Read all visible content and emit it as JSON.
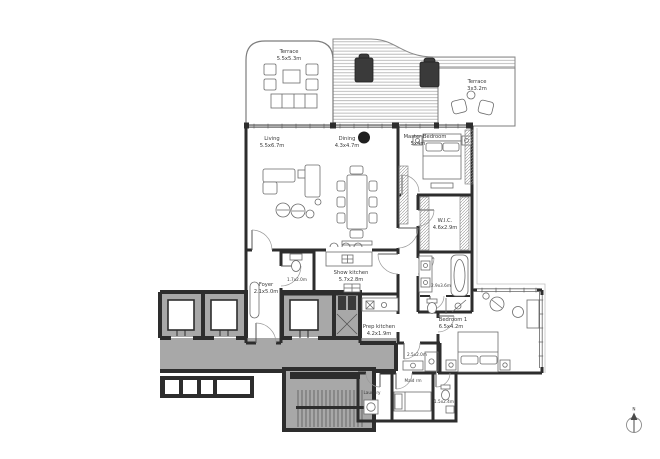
{
  "plan": {
    "rooms": {
      "terrace_left": {
        "name": "Terrace",
        "dims": "5.5x5.3m"
      },
      "terrace_right": {
        "name": "Terrace",
        "dims": "3x3.2m"
      },
      "living": {
        "name": "Living",
        "dims": "5.5x6.7m"
      },
      "dining": {
        "name": "Dining",
        "dims": "4.3x4.7m"
      },
      "master_bedroom": {
        "name": "Master Bedroom",
        "dims": "5x4m"
      },
      "wic": {
        "name": "W.I.C.",
        "dims": "4.6x2.9m"
      },
      "master_bathroom": {
        "dims": "2.9x3.6m"
      },
      "bedroom1": {
        "name": "Bedroom 1",
        "dims": "6.5x4.2m"
      },
      "foyer": {
        "name": "Foyer",
        "dims": "2.1x5.0m"
      },
      "powder_room": {
        "dims": "1.7x2.0m"
      },
      "show_kitchen": {
        "name": "Show kitchen",
        "dims": "5.7x2.8m"
      },
      "prep_kitchen": {
        "name": "Prep kitchen",
        "dims": "4.2x1.9m"
      },
      "guest_bathroom": {
        "dims": "2.5x2.0m"
      },
      "maid_room": {
        "name": "Maid rm"
      },
      "laundry": {
        "name": "Laundry"
      },
      "maid_bathroom": {
        "dims": "1.5x2.4m"
      }
    },
    "compass": {
      "label": "N"
    },
    "colors": {
      "wall": "#2d2d2d",
      "core_fill": "#a8a8a8",
      "accent_dark": "#1f1f1f"
    }
  }
}
